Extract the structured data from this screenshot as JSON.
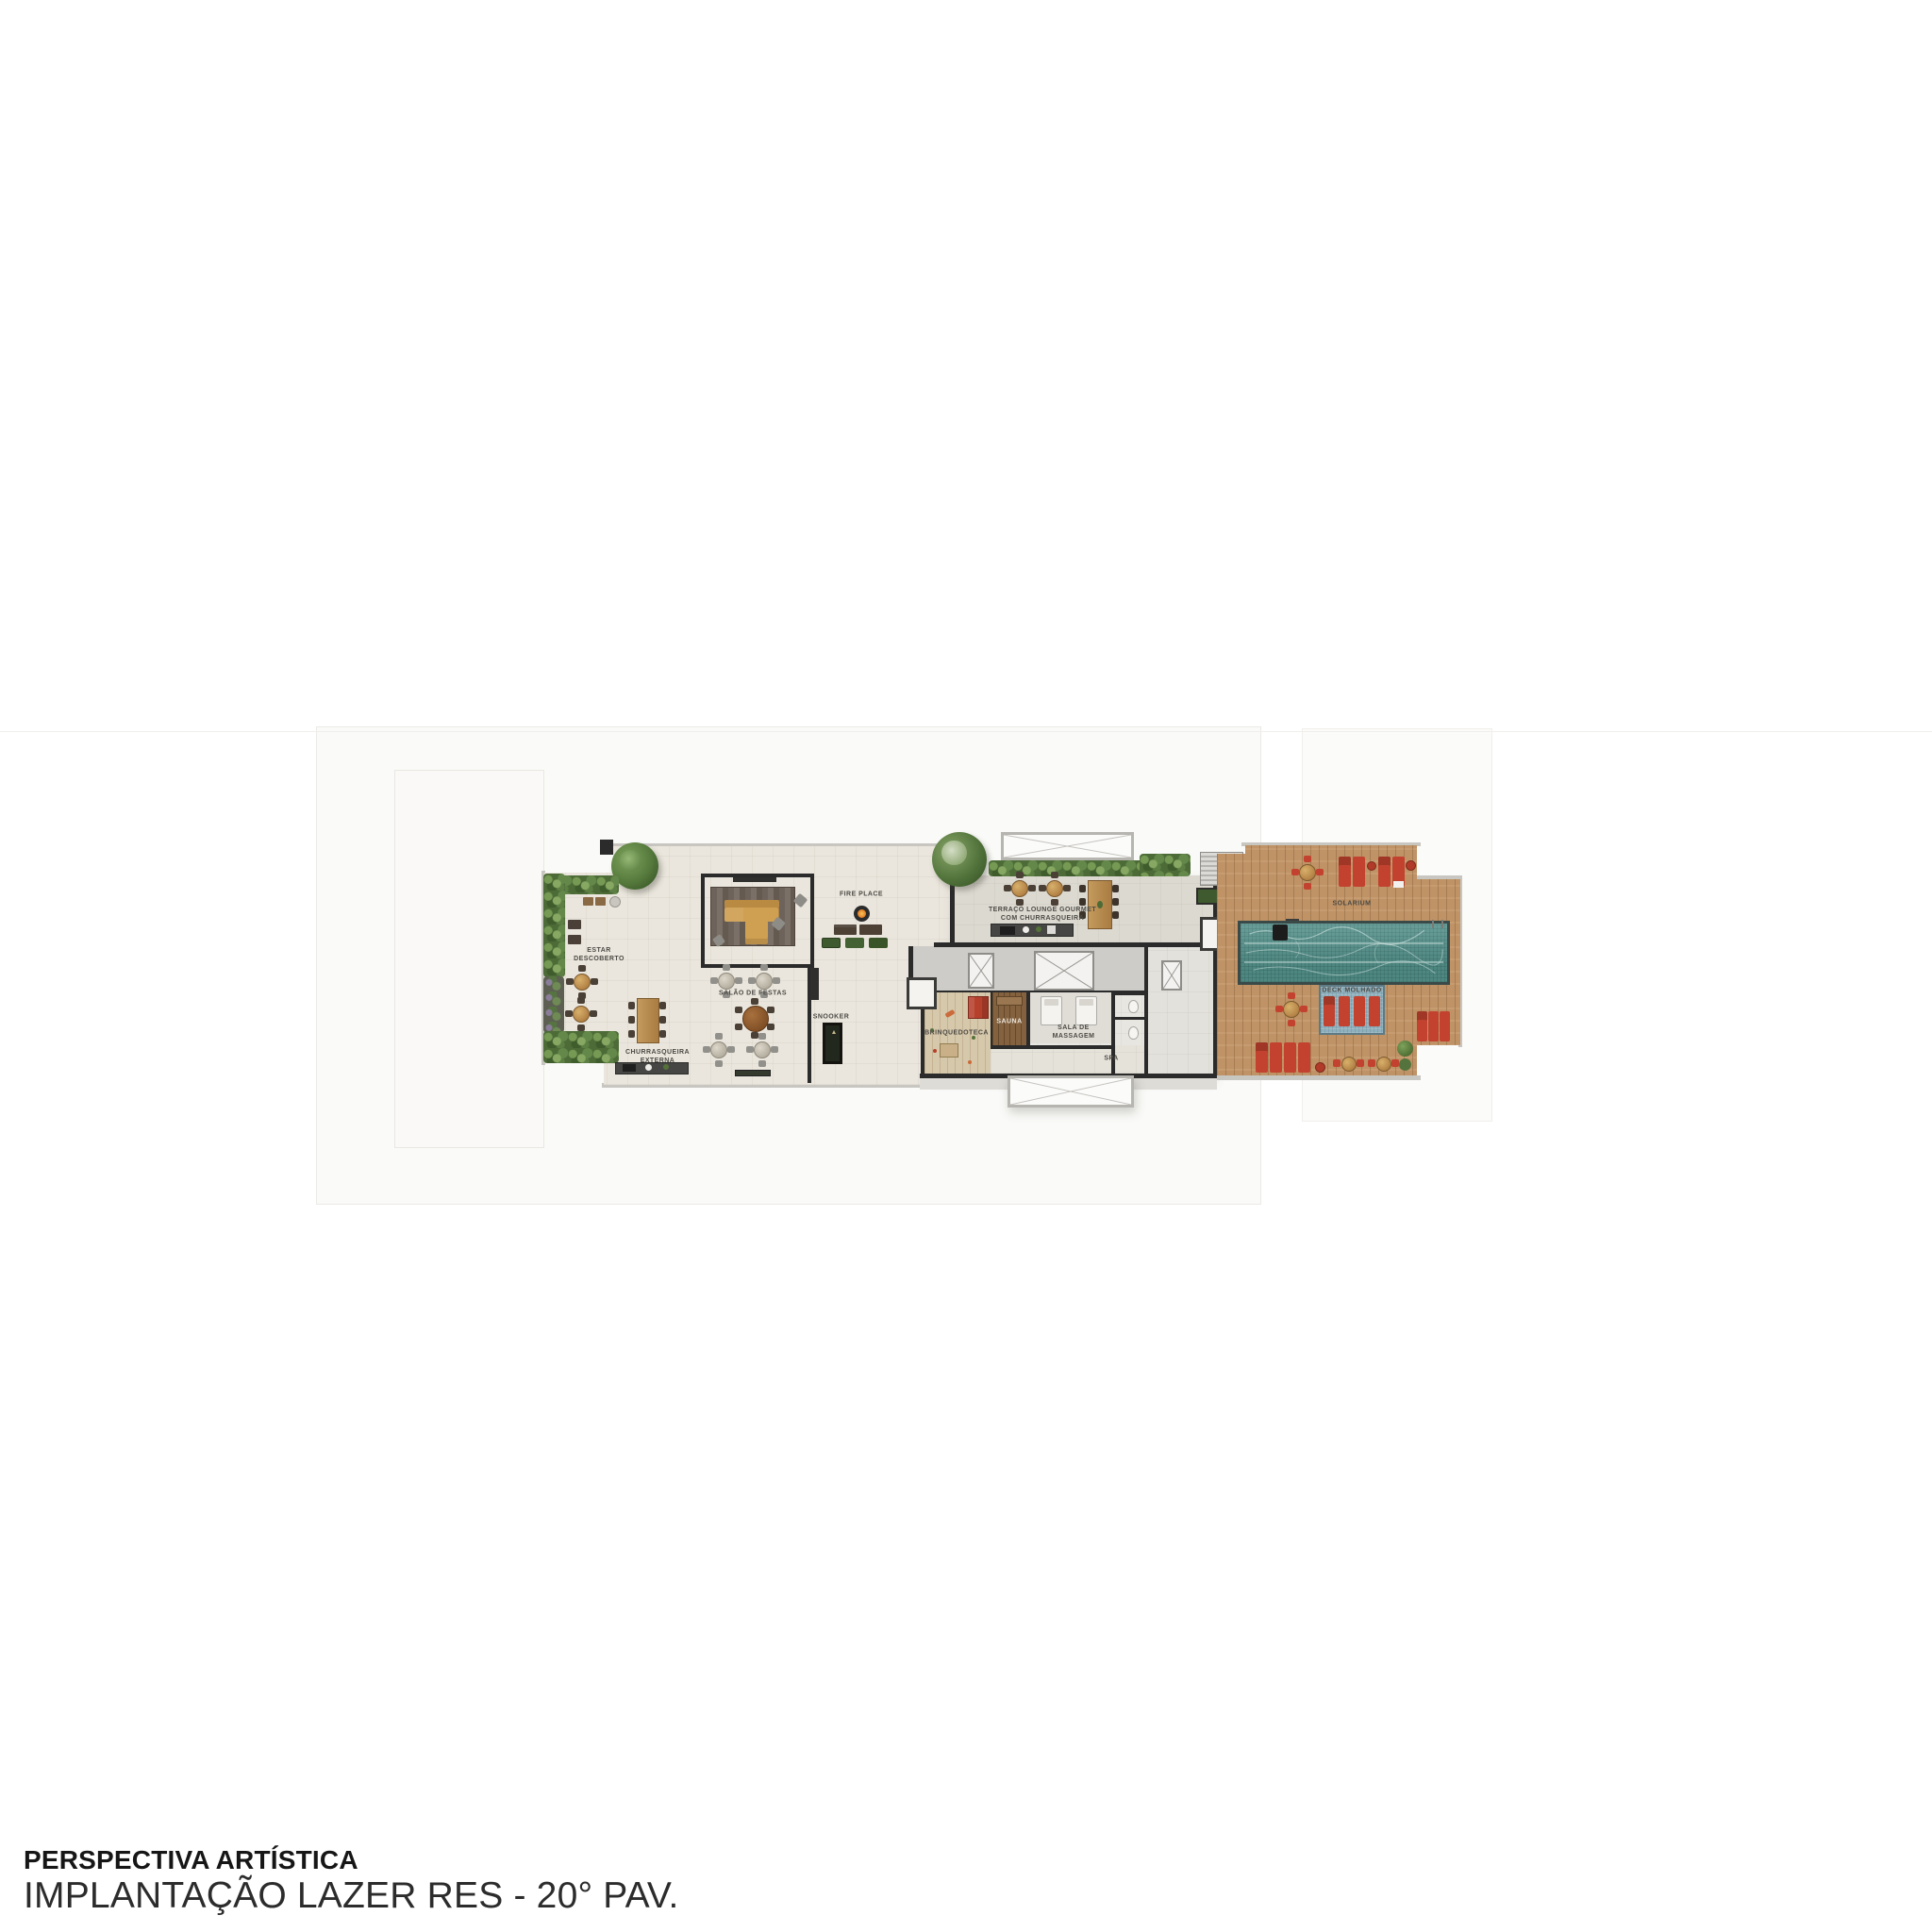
{
  "caption": {
    "line1": "PERSPECTIVA ARTÍSTICA",
    "line2": "IMPLANTAÇÃO LAZER RES - 20° PAV."
  },
  "plan": {
    "labels": {
      "estar1": "ESTAR",
      "estar2": "DESCOBERTO",
      "churrasqueira1": "CHURRASQUEIRA",
      "churrasqueira2": "EXTERNA",
      "salao": "SALÃO DE FESTAS",
      "snooker": "SNOOKER",
      "fire_place": "FIRE PLACE",
      "terraco1": "TERRAÇO LOUNGE GOURMET",
      "terraco2": "COM CHURRASQUEIRA",
      "brinquedoteca": "BRINQUEDOTECA",
      "sauna": "SAUNA",
      "massagem1": "SALA DE",
      "massagem2": "MASSAGEM",
      "spa": "SPA",
      "solarium": "SOLARIUM",
      "deck_molhado": "DECK MOLHADO"
    }
  },
  "colors": {
    "wall": "#2b2b2b",
    "floorBeige": "#eae6dd",
    "floorGray": "#dcd9d1",
    "corridor": "#cdccc8",
    "woodDeck": "#bf9366",
    "poolWater": "#5a968f",
    "wetDeck": "#8fb0bd",
    "red": "#c2422f",
    "sofaYellow": "#cf9f52",
    "hedgeGreen": "#55743d"
  }
}
